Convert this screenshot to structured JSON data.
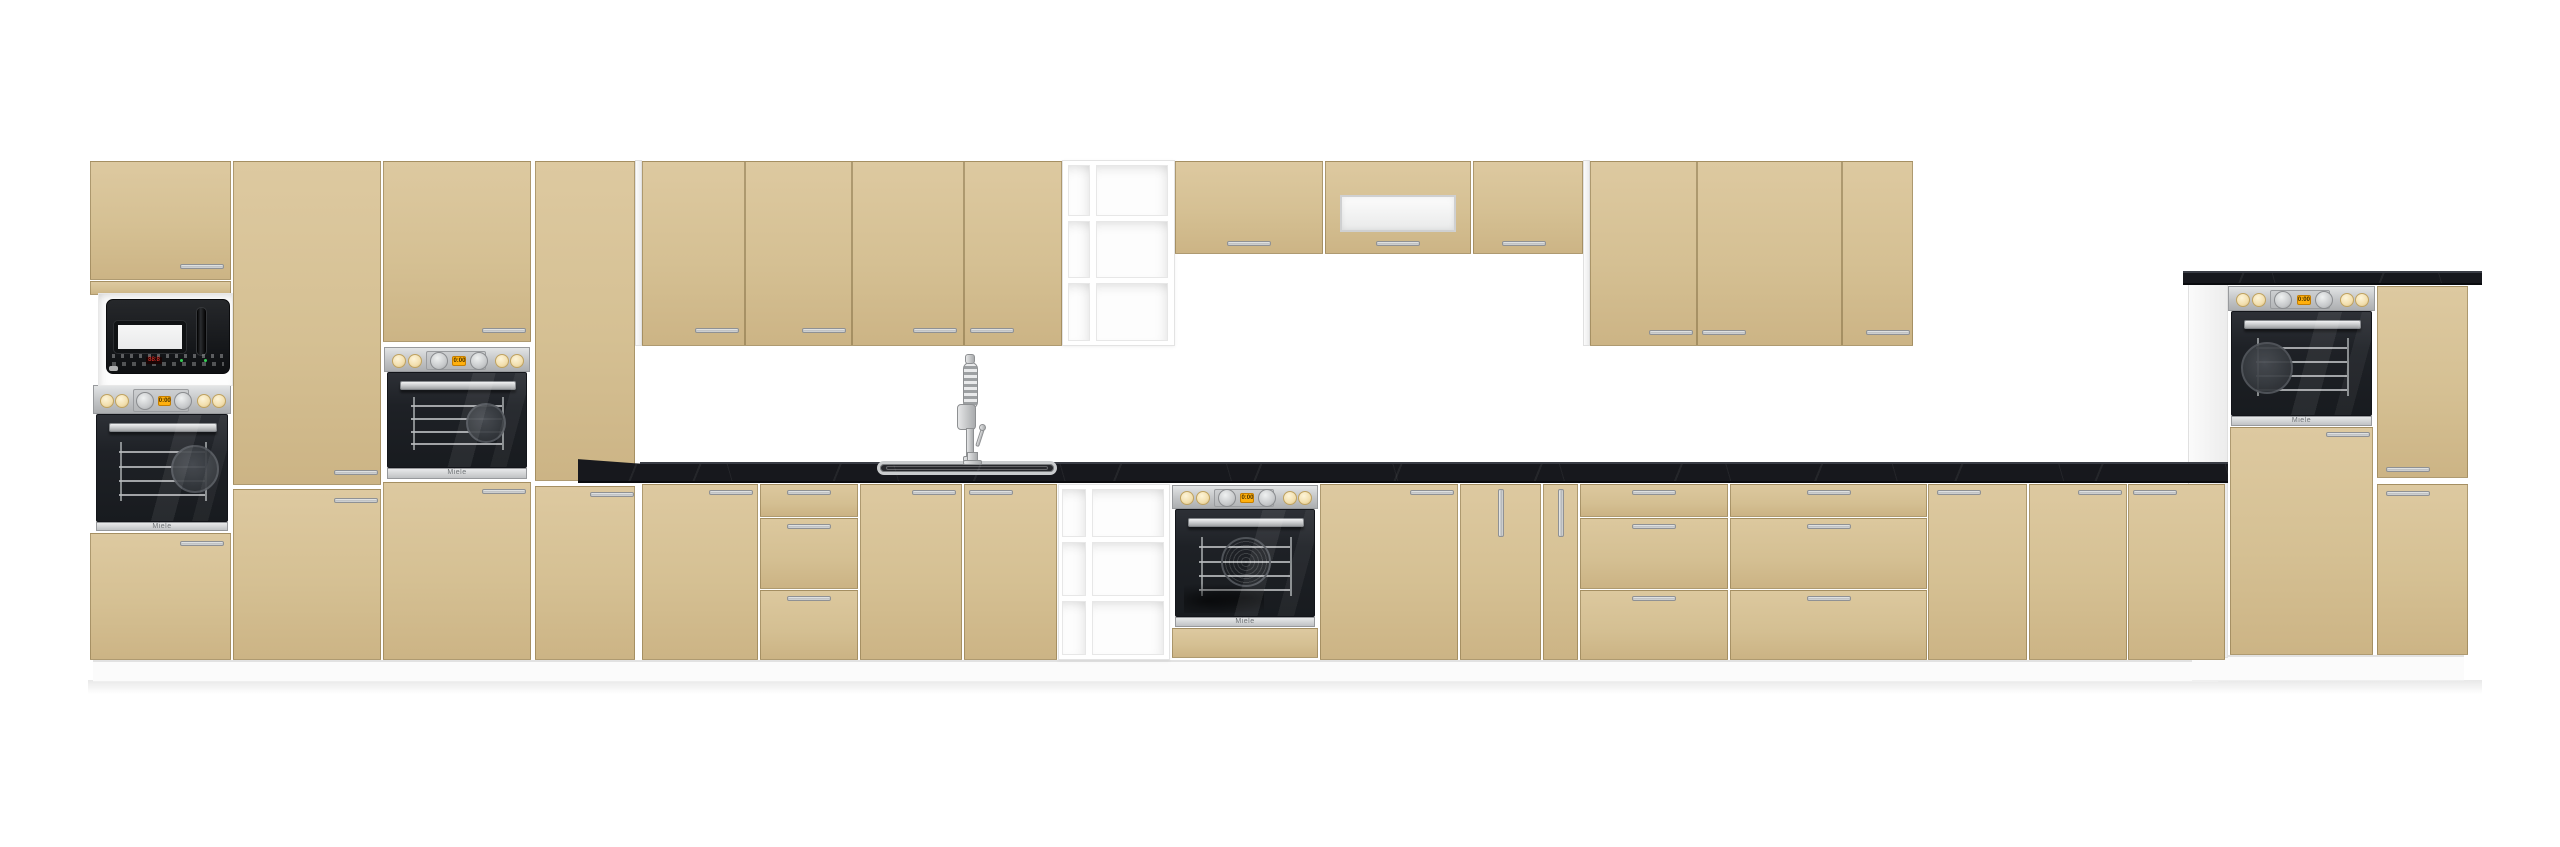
{
  "scene": {
    "title": "kitchen-furniture-set-render",
    "width": 2560,
    "height": 847,
    "colors": {
      "front_beige": "#d5c093",
      "front_beige_light": "#ddc9a0",
      "front_beige_dark": "#ccb485",
      "carcass_white": "#f3f3f3",
      "worktop_black": "#17181d",
      "worktop_highlight": "#3a3d45",
      "steel": "#c9cbcd",
      "oven_black": "#1e2126",
      "knob_cream": "#f5e5ba",
      "display_orange": "#ffb00d",
      "digit_red": "#ff3a30",
      "dot_green": "#35d054",
      "plinth_white": "#fbfbfb",
      "background": "#ffffff"
    }
  },
  "texts": {
    "oven_brand": "Miele",
    "oven_display": "0:00",
    "microwave_display": "88:8"
  },
  "kitchen": {
    "plinths": [
      {
        "x": 93,
        "y": 660,
        "w": 2125,
        "h": 22
      },
      {
        "x": 2192,
        "y": 655,
        "w": 272,
        "h": 26
      }
    ],
    "floor_shadow": {
      "x": 88,
      "y": 680,
      "w": 2394,
      "h": 14
    },
    "carcass_panels": [
      {
        "name": "wall-run-side-panel",
        "x": 635,
        "y": 160,
        "w": 7,
        "h": 186
      },
      {
        "name": "wall-run-side-panel",
        "x": 1583,
        "y": 160,
        "w": 7,
        "h": 186
      },
      {
        "name": "right-unit-side-panel",
        "x": 2188,
        "y": 283,
        "w": 40,
        "h": 375
      }
    ],
    "counters": {
      "main": {
        "x": 640,
        "y": 462,
        "w": 1588,
        "h": 21
      },
      "wedge": {
        "x": 578,
        "y": 457,
        "w": 64,
        "h": 26
      },
      "high": {
        "x": 2183,
        "y": 271,
        "w": 299,
        "h": 14
      }
    },
    "sink": {
      "x": 877,
      "y": 461,
      "w": 180,
      "h": 14
    },
    "faucet": {
      "x": 955,
      "y": 352
    },
    "doors": [
      {
        "name": "tall-cab1-top-door",
        "x": 90,
        "y": 161,
        "w": 141,
        "h": 119,
        "handle": [
          180,
          264
        ]
      },
      {
        "name": "tall-cab1-filler-panel",
        "x": 90,
        "y": 281,
        "w": 141,
        "h": 14
      },
      {
        "name": "tall-cab1-bottom-door",
        "x": 90,
        "y": 533,
        "w": 141,
        "h": 127,
        "handle": [
          180,
          541
        ]
      },
      {
        "name": "tall-cab2-upper-door",
        "x": 233,
        "y": 161,
        "w": 148,
        "h": 324,
        "handle": [
          334,
          470
        ]
      },
      {
        "name": "tall-cab2-lower-door",
        "x": 233,
        "y": 489,
        "w": 148,
        "h": 171,
        "handle": [
          334,
          498
        ]
      },
      {
        "name": "tall-cab3-top-door",
        "x": 383,
        "y": 161,
        "w": 148,
        "h": 181,
        "handle": [
          482,
          328
        ]
      },
      {
        "name": "tall-cab3-bottom-door",
        "x": 383,
        "y": 482,
        "w": 148,
        "h": 178,
        "handle": [
          482,
          489
        ]
      },
      {
        "name": "tall-cab4-upper-door",
        "x": 535,
        "y": 161,
        "w": 100,
        "h": 320
      },
      {
        "name": "tall-cab4-lower-door",
        "x": 535,
        "y": 486,
        "w": 100,
        "h": 174,
        "handle": [
          590,
          492
        ]
      },
      {
        "name": "wall-door-1",
        "x": 642,
        "y": 161,
        "w": 103,
        "h": 185,
        "handle": [
          695,
          328
        ]
      },
      {
        "name": "wall-door-2",
        "x": 745,
        "y": 161,
        "w": 107,
        "h": 185,
        "handle": [
          802,
          328
        ]
      },
      {
        "name": "wall-door-3",
        "x": 852,
        "y": 161,
        "w": 112,
        "h": 185,
        "handle": [
          913,
          328
        ]
      },
      {
        "name": "wall-door-4",
        "x": 964,
        "y": 161,
        "w": 98,
        "h": 185,
        "handle": [
          970,
          328
        ]
      },
      {
        "name": "short-wall-door-1",
        "x": 1175,
        "y": 161,
        "w": 148,
        "h": 93,
        "handle": [
          1227,
          241
        ]
      },
      {
        "name": "short-wall-door-glass",
        "x": 1325,
        "y": 161,
        "w": 146,
        "h": 93,
        "handle": [
          1376,
          241
        ],
        "glass": [
          1340,
          195,
          116,
          37
        ]
      },
      {
        "name": "short-wall-door-2",
        "x": 1473,
        "y": 161,
        "w": 110,
        "h": 93,
        "handle": [
          1502,
          241
        ]
      },
      {
        "name": "wall-door-5",
        "x": 1590,
        "y": 161,
        "w": 107,
        "h": 185,
        "handle": [
          1649,
          330
        ]
      },
      {
        "name": "wall-door-6",
        "x": 1697,
        "y": 161,
        "w": 145,
        "h": 185,
        "handle": [
          1702,
          330
        ]
      },
      {
        "name": "wall-door-7",
        "x": 1842,
        "y": 161,
        "w": 71,
        "h": 185,
        "handle": [
          1866,
          330
        ]
      },
      {
        "name": "base-door-1",
        "x": 642,
        "y": 484,
        "w": 116,
        "h": 176,
        "handle": [
          709,
          490
        ]
      },
      {
        "name": "base-sink-door-left",
        "x": 860,
        "y": 484,
        "w": 102,
        "h": 176,
        "handle": [
          912,
          490
        ]
      },
      {
        "name": "base-sink-door-right",
        "x": 964,
        "y": 484,
        "w": 93,
        "h": 176,
        "handle": [
          969,
          490
        ]
      },
      {
        "name": "base-door-2",
        "x": 1320,
        "y": 484,
        "w": 138,
        "h": 176,
        "handle": [
          1410,
          490
        ]
      },
      {
        "name": "oven-base-bottom-panel",
        "x": 1172,
        "y": 628,
        "w": 146,
        "h": 30
      },
      {
        "name": "base-door-3",
        "x": 1928,
        "y": 484,
        "w": 99,
        "h": 176,
        "handle": [
          1937,
          490
        ]
      },
      {
        "name": "base-door-4",
        "x": 2029,
        "y": 484,
        "w": 98,
        "h": 176,
        "handle": [
          2078,
          490
        ]
      },
      {
        "name": "base-door-5",
        "x": 2128,
        "y": 484,
        "w": 97,
        "h": 176,
        "handle": [
          2133,
          490
        ]
      },
      {
        "name": "right-oven-lower-door",
        "x": 2230,
        "y": 427,
        "w": 143,
        "h": 228,
        "handle": [
          2326,
          432
        ]
      },
      {
        "name": "right-unit-upper-door",
        "x": 2377,
        "y": 286,
        "w": 91,
        "h": 192,
        "handle": [
          2386,
          467
        ]
      },
      {
        "name": "right-unit-lower-door",
        "x": 2377,
        "y": 484,
        "w": 91,
        "h": 171,
        "handle": [
          2386,
          491
        ]
      }
    ],
    "drawer_stacks": [
      {
        "name": "drawer-stack-1",
        "x": 760,
        "w": 98,
        "rows": [
          [
            484,
            33
          ],
          [
            518,
            71
          ],
          [
            590,
            70
          ]
        ]
      },
      {
        "name": "drawer-stack-2",
        "x": 1580,
        "w": 148,
        "rows": [
          [
            484,
            33
          ],
          [
            518,
            71
          ],
          [
            590,
            70
          ]
        ]
      },
      {
        "name": "drawer-stack-3",
        "x": 1730,
        "w": 197,
        "rows": [
          [
            484,
            33
          ],
          [
            518,
            71
          ],
          [
            590,
            70
          ]
        ]
      }
    ],
    "pullouts": [
      {
        "name": "cargo-pullout-30",
        "x": 1460,
        "y": 484,
        "w": 81,
        "h": 176
      },
      {
        "name": "cargo-pullout-15",
        "x": 1543,
        "y": 484,
        "w": 35,
        "h": 176
      }
    ],
    "shelf_units": [
      {
        "name": "open-shelf-wall-unit",
        "x": 1062,
        "y": 160,
        "w": 113,
        "h": 186,
        "cols": [
          [
            1068,
            22
          ],
          [
            1096,
            72
          ]
        ],
        "shelves": [
          221,
          283
        ]
      },
      {
        "name": "open-shelf-base-unit",
        "x": 1058,
        "y": 484,
        "w": 112,
        "h": 176,
        "cols": [
          [
            1062,
            24
          ],
          [
            1092,
            72
          ]
        ],
        "shelves": [
          542,
          601
        ]
      }
    ],
    "ovens": [
      {
        "name": "built-in-oven-tall-left",
        "x": 93,
        "w": 138,
        "strip": [
          385,
          29
        ],
        "door": [
          414,
          108
        ],
        "lip": [
          522,
          7
        ],
        "pan": [
          0.74,
          0.5,
          24
        ]
      },
      {
        "name": "built-in-oven-tall-mid",
        "x": 384,
        "w": 146,
        "strip": [
          347,
          25
        ],
        "door": [
          372,
          96
        ],
        "lip": [
          468,
          9
        ],
        "pan": [
          0.7,
          0.52,
          20
        ]
      },
      {
        "name": "built-in-oven-base",
        "x": 1172,
        "w": 146,
        "strip": [
          485,
          24
        ],
        "door": [
          509,
          108
        ],
        "lip": [
          617,
          8
        ],
        "pan": [
          0.5,
          0.48,
          25
        ],
        "speckle": true,
        "hob": true
      },
      {
        "name": "built-in-oven-right",
        "x": 2228,
        "w": 147,
        "strip": [
          286,
          25
        ],
        "door": [
          311,
          105
        ],
        "lip": [
          416,
          8
        ],
        "pan": [
          0.25,
          0.53,
          26
        ]
      }
    ],
    "microwave": {
      "niche": [
        98,
        293,
        135,
        93
      ],
      "body": [
        106,
        299,
        124,
        75
      ],
      "window": [
        114,
        321,
        72,
        32
      ],
      "handle": [
        196,
        307,
        11,
        49
      ],
      "panel": [
        112,
        354,
        112,
        16
      ],
      "display": [
        146,
        357,
        16,
        7
      ],
      "logo": [
        109,
        366,
        9,
        5
      ]
    }
  }
}
